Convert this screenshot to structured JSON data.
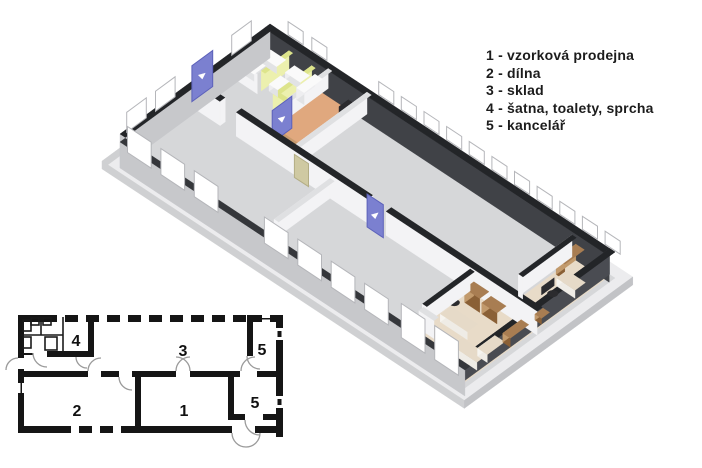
{
  "legend": {
    "items": [
      "1 - vzorková prodejna",
      "2 - dílna",
      "3 - sklad",
      "4 - šatna, toalety, sprcha",
      "5 - kancelář"
    ]
  },
  "plan2d": {
    "labels": {
      "room4": "4",
      "room3": "3",
      "room5_top": "5",
      "room2": "2",
      "room1": "1",
      "room5_bottom": "5"
    }
  },
  "plan3d": {
    "colors": {
      "background": "#ffffff",
      "slab_rim": "#ececee",
      "slab_edge": "#cfd0d2",
      "slab_edge_dark": "#c2c3c6",
      "floor": "#d6d7d9",
      "wall_dark_top": "#232528",
      "wall_dark_face": "#404247",
      "wall_dark_face2": "#4a4c52",
      "wall_near_face": "#c7c8cb",
      "wall_near_top": "#35373b",
      "wall_white": "#f3f3f5",
      "wall_white_top": "#dfe0e2",
      "window_frame": "#ffffff",
      "window_stroke": "#b5b6ba",
      "door_blue": "#7b80d0",
      "door_blue_dark": "#5c61ba",
      "door_tan": "#cfc9a2",
      "door_tan_dark": "#b3ad85",
      "wall_yellow": "#ecf0ae",
      "wall_yellow_side": "#dde48b",
      "floor_orange": "#e0a87e",
      "floor_tan": "#e8dbc8",
      "wood": "#a87d52",
      "wood_dark": "#8a6036",
      "wood_light": "#c29a6c",
      "desk_top": "#e6dac8",
      "desk_side": "#efece6",
      "desk_side2": "#f6f4ef",
      "fixture_top": "#fafafa",
      "fixture_side": "#e2e3e5",
      "fixture_side2": "#eeeef0",
      "bench": "#c69a6e",
      "bench_dark": "#a97f55",
      "chair": "#2b2b2e"
    }
  }
}
